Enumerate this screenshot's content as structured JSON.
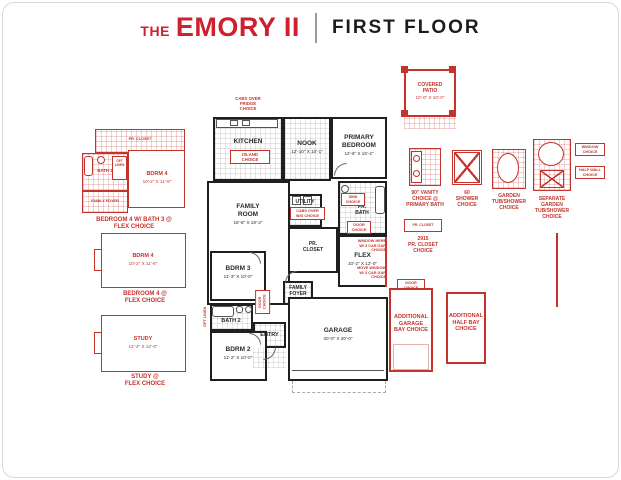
{
  "header": {
    "the": "THE",
    "name": "EMORY II",
    "floor": "FIRST FLOOR"
  },
  "rooms": {
    "cabs_fridge": "CABS OVER\nFRIDGE\nCHOICE",
    "kitchen": "KITCHEN",
    "island": "ISLAND\nCHOICE",
    "nook": "NOOK",
    "nook_dims": "12'-10\" X 10'-1\"",
    "primary": "PRIMARY\nBEDROOM",
    "primary_dims": "12'-6\" X 15'-2\"",
    "family": "FAMILY\nROOM",
    "family_dims": "16'-8\" X 19'-2\"",
    "utility": "UTILITY",
    "utility_note": "CABS OVER\nW/D CHOICE",
    "pr_bath": "PR.\nBATH",
    "sink_note": "SINK\nCHOICE",
    "door_note": "DOOR\nCHOICE",
    "pr_closet": "PR.\nCLOSET",
    "flex": "FLEX",
    "flex_dims": "10'-2\" X 12'-0\"",
    "window_note": "WINDOW HERE\nW/ 3 CAR GAR\nCHOICE",
    "move_window_note": "MOVE WINDOW\nW/ 3 CAR GAR\nCHOICE",
    "bdrm3": "BDRM 3",
    "bdrm3_dims": "11'-3\" X 10'-0\"",
    "family_foyer": "FAMILY\nFOYER",
    "bath2": "BATH 2",
    "bath2_note": "OPT LINEN",
    "hall_door_note": "DOOR CHOICE",
    "entry": "ENTRY",
    "bdrm2": "BDRM 2",
    "bdrm2_dims": "11'-2\" X 10'-0\"",
    "garage": "GARAGE",
    "garage_dims": "20'-0\" X 20'-0\""
  },
  "left_options": {
    "opt1": {
      "pr_closet": "PR. CLOSET",
      "bath3": "BATH 3",
      "linen": "OPT\nLINEN",
      "bdrm4": "BDRM 4",
      "bdrm4_dims": "10'-2\" X 11'-8\"",
      "foyer": "FAMILY FOYER",
      "caption": "BEDROOM 4 W/ BATH 3 @\nFLEX CHOICE"
    },
    "opt2": {
      "bdrm4": "BDRM 4",
      "dims": "10'-2\" X 11'-8\"",
      "caption": "BEDROOM 4 @\nFLEX CHOICE"
    },
    "opt3": {
      "study": "STUDY",
      "dims": "12'-4\" X 12'-0\"",
      "caption": "STUDY @\nFLEX CHOICE"
    }
  },
  "right_options": {
    "patio": {
      "label": "COVERED\nPATIO",
      "dims": "10'-0\" X 10'-0\""
    },
    "vanity": {
      "caption": "90\" VANITY\nCHOICE @\nPRIMARY BATH"
    },
    "shower": {
      "caption": "60\nSHOWER\nCHOICE"
    },
    "garden": {
      "caption": "GARDEN\nTUB/SHOWER\nCHOICE"
    },
    "separate": {
      "caption": "SEPARATE\nGARDEN\nTUB/SHOWER\nCHOICE",
      "window_note": "WINDOW\nCHOICE",
      "halfwall_note": "HALF WALL\nCHOICE"
    },
    "pr_closet": {
      "label": "PR. CLOSET",
      "caption": "2915\nPR. CLOSET\nCHOICE"
    },
    "garage_bay": {
      "door_note": "DOOR\nCHOICE",
      "caption": "ADDITIONAL\nGARAGE\nBAY CHOICE"
    },
    "half_bay": {
      "caption": "ADDITIONAL\nHALF BAY\nCHOICE"
    }
  },
  "colors": {
    "plan_red": "#c5342c",
    "title_red": "#cf2030",
    "wall_black": "#1f1f1f"
  }
}
